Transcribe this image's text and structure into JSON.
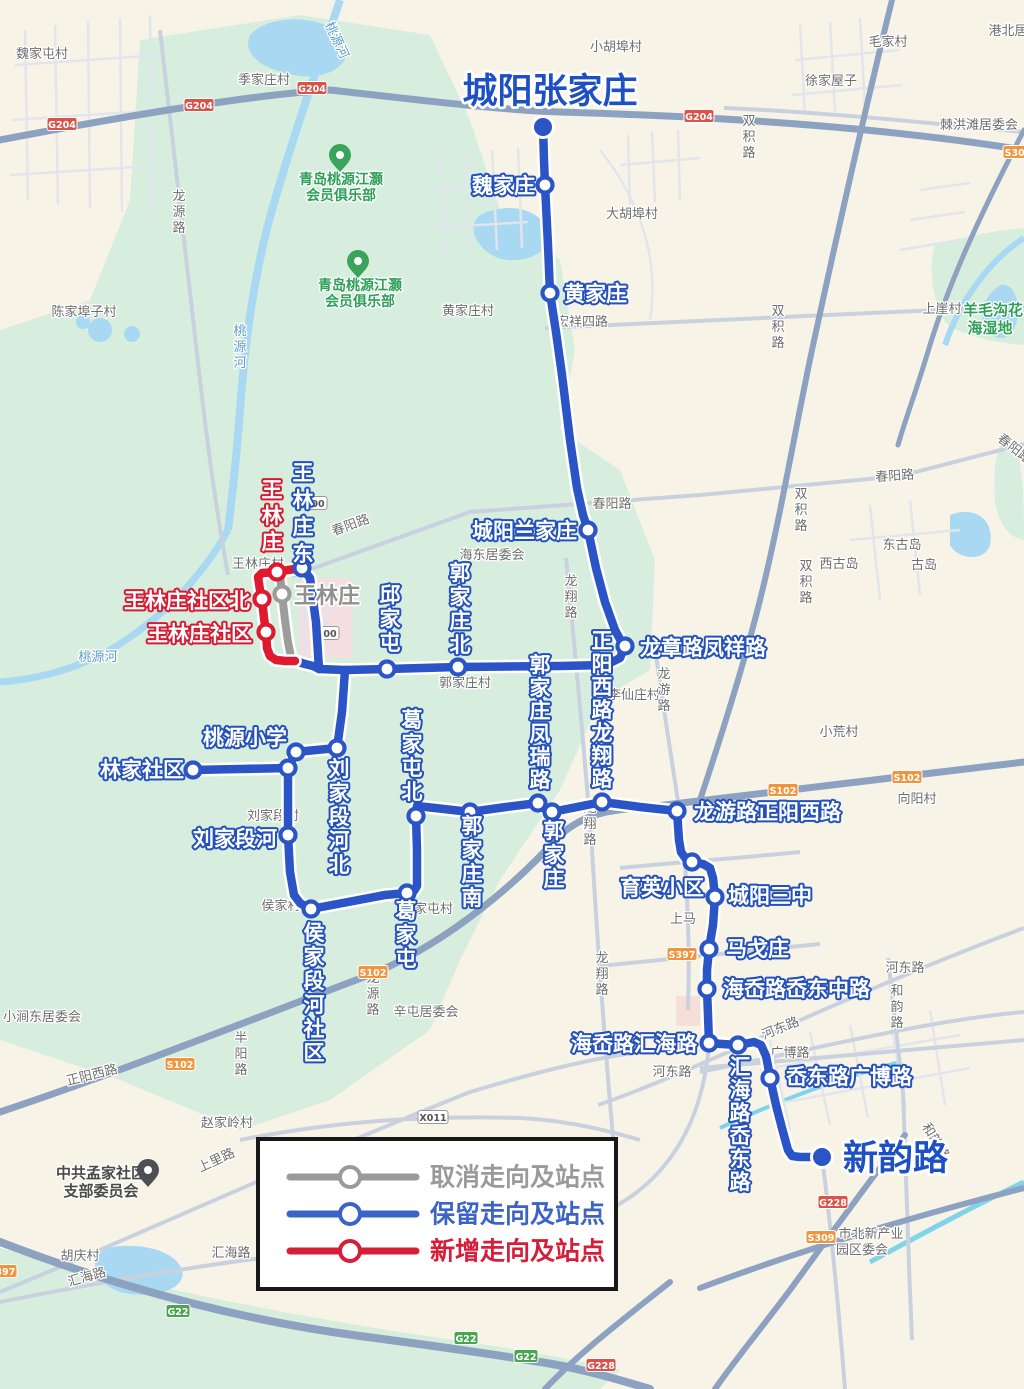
{
  "title": "城阳张家庄",
  "terminal_end": "新韵路",
  "legend": {
    "items": [
      {
        "label": "取消走向及站点",
        "color": "#9a9a9a"
      },
      {
        "label": "保留走向及站点",
        "color": "#3c63c6"
      },
      {
        "label": "新增走向及站点",
        "color": "#d61e39"
      }
    ]
  },
  "map": {
    "colors": {
      "blue": "#2b55c6",
      "red": "#de1a31",
      "gray": "#9c9c9c",
      "label_blue_outline": "#2350bb",
      "label_red_outline": "#d61a31",
      "title_blue": "#1d50c4",
      "bg_beige": "#f8f3e7",
      "bg_green": "#d7eede",
      "water": "#a9d9f2"
    },
    "route": {
      "blue": [
        "543,127 544,160 545,185 548,245 550,293 556,332 562,375 570,440 577,488 583,515 588,530 596,568 605,602 615,630 622,643 625,646",
        "625,646 620,658 606,665 560,666 458,667 387,669 345,670 319,669",
        "319,669 316,622 310,578 302,568",
        "295,661 305,664 313,666 319,669",
        "345,670 342,712 337,748",
        "337,748 316,750 296,752 288,768",
        "288,768 240,769 193,770",
        "288,768 288,820 288,835 290,872 294,895 300,903 308,908 311,909",
        "311,909 348,902 385,895 407,893 414,891 417,886 417,850 416,816 417,806",
        "417,806 444,809 470,812 506,807 538,803 546,810 552,812 577,807 602,802 640,807 677,811",
        "677,811 679,840 681,852 686,859 692,862 703,864 710,868 713,878 715,897 713,925 709,949 707,970 707,989 708,1015 709,1043",
        "709,1043 722,1044 738,1045 754,1042 761,1045 766,1056 768,1066 770,1078 776,1105 783,1132 788,1150 792,1156 800,1157 822,1157"
      ],
      "red": [
        "302,568 288,570 277,572 262,573 258,577 260,590 262,599 264,618 266,632 267,648 270,656 276,660 286,661 295,661"
      ],
      "gray": [
        "280,573 281,585 282,594 285,620 288,642 291,657"
      ]
    },
    "stops": [
      {
        "x": 543,
        "y": 127,
        "t": "T"
      },
      {
        "x": 822,
        "y": 1157,
        "t": "T"
      },
      {
        "x": 545,
        "y": 185,
        "t": "b"
      },
      {
        "x": 550,
        "y": 293,
        "t": "b"
      },
      {
        "x": 588,
        "y": 530,
        "t": "b"
      },
      {
        "x": 625,
        "y": 646,
        "t": "b"
      },
      {
        "x": 302,
        "y": 568,
        "t": "b"
      },
      {
        "x": 387,
        "y": 669,
        "t": "b"
      },
      {
        "x": 458,
        "y": 667,
        "t": "b"
      },
      {
        "x": 337,
        "y": 748,
        "t": "b"
      },
      {
        "x": 296,
        "y": 752,
        "t": "b"
      },
      {
        "x": 288,
        "y": 768,
        "t": "b"
      },
      {
        "x": 193,
        "y": 770,
        "t": "b"
      },
      {
        "x": 288,
        "y": 835,
        "t": "b"
      },
      {
        "x": 311,
        "y": 909,
        "t": "b"
      },
      {
        "x": 407,
        "y": 893,
        "t": "b"
      },
      {
        "x": 416,
        "y": 816,
        "t": "b"
      },
      {
        "x": 470,
        "y": 812,
        "t": "b"
      },
      {
        "x": 538,
        "y": 803,
        "t": "b"
      },
      {
        "x": 552,
        "y": 812,
        "t": "b"
      },
      {
        "x": 602,
        "y": 802,
        "t": "b"
      },
      {
        "x": 677,
        "y": 811,
        "t": "b"
      },
      {
        "x": 692,
        "y": 862,
        "t": "b"
      },
      {
        "x": 715,
        "y": 897,
        "t": "b"
      },
      {
        "x": 709,
        "y": 949,
        "t": "b"
      },
      {
        "x": 707,
        "y": 989,
        "t": "b"
      },
      {
        "x": 709,
        "y": 1043,
        "t": "b"
      },
      {
        "x": 738,
        "y": 1045,
        "t": "b"
      },
      {
        "x": 770,
        "y": 1078,
        "t": "b"
      },
      {
        "x": 277,
        "y": 572,
        "t": "r"
      },
      {
        "x": 262,
        "y": 599,
        "t": "r"
      },
      {
        "x": 266,
        "y": 632,
        "t": "r"
      },
      {
        "x": 282,
        "y": 594,
        "t": "g"
      }
    ],
    "stop_labels": [
      {
        "t": "城阳张家庄",
        "x": 550,
        "y": 103,
        "s": "T",
        "a": "middle"
      },
      {
        "t": "新韵路",
        "x": 843,
        "y": 1170,
        "s": "T"
      },
      {
        "t": "魏家庄",
        "x": 535,
        "y": 193,
        "a": "end"
      },
      {
        "t": "黄家庄",
        "x": 564,
        "y": 301
      },
      {
        "t": "城阳兰家庄",
        "x": 577,
        "y": 538,
        "a": "end"
      },
      {
        "t": "龙章路凤祥路",
        "x": 640,
        "y": 655
      },
      {
        "t": "王林庄东",
        "x": 303,
        "y": 480,
        "v": 1,
        "step": 27
      },
      {
        "t": "王林庄",
        "x": 272,
        "y": 497,
        "v": 1,
        "s": "R",
        "step": 26
      },
      {
        "t": "王林庄",
        "x": 294,
        "y": 603,
        "s": "G",
        "size": 22
      },
      {
        "t": "王林庄社区北",
        "x": 250,
        "y": 608,
        "s": "R",
        "a": "end"
      },
      {
        "t": "王林庄社区",
        "x": 252,
        "y": 641,
        "s": "R",
        "a": "end"
      },
      {
        "t": "邱家屯",
        "x": 390,
        "y": 602,
        "v": 1
      },
      {
        "t": "郭家庄北",
        "x": 460,
        "y": 580,
        "v": 1
      },
      {
        "t": "郭家庄凤瑞路",
        "x": 540,
        "y": 672,
        "v": 1,
        "size": 21,
        "step": 23
      },
      {
        "t": "正阳西路龙翔路",
        "x": 602,
        "y": 648,
        "v": 1,
        "size": 21,
        "step": 23
      },
      {
        "t": "桃源小学",
        "x": 287,
        "y": 745,
        "a": "end"
      },
      {
        "t": "林家社区",
        "x": 184,
        "y": 777,
        "a": "end"
      },
      {
        "t": "刘家段河北",
        "x": 339,
        "y": 776,
        "v": 1,
        "step": 24
      },
      {
        "t": "刘家段河",
        "x": 277,
        "y": 846,
        "a": "end"
      },
      {
        "t": "侯家段河社区",
        "x": 314,
        "y": 940,
        "v": 1,
        "step": 24
      },
      {
        "t": "葛家屯北",
        "x": 412,
        "y": 727,
        "v": 1,
        "step": 24
      },
      {
        "t": "葛家屯",
        "x": 406,
        "y": 918,
        "v": 1,
        "step": 24
      },
      {
        "t": "郭家庄南",
        "x": 472,
        "y": 833,
        "v": 1,
        "step": 24
      },
      {
        "t": "郭家庄",
        "x": 554,
        "y": 838,
        "v": 1,
        "step": 24
      },
      {
        "t": "龙游路正阳西路",
        "x": 694,
        "y": 819
      },
      {
        "t": "育英小区",
        "x": 704,
        "y": 895,
        "a": "end"
      },
      {
        "t": "城阳三中",
        "x": 728,
        "y": 903
      },
      {
        "t": "马戈庄",
        "x": 726,
        "y": 956
      },
      {
        "t": "海岙路岙东中路",
        "x": 723,
        "y": 996
      },
      {
        "t": "海岙路汇海路",
        "x": 697,
        "y": 1051,
        "a": "end"
      },
      {
        "t": "汇海路岙东路",
        "x": 740,
        "y": 1074,
        "v": 1,
        "size": 21,
        "step": 23
      },
      {
        "t": "岙东路广博路",
        "x": 786,
        "y": 1084
      }
    ],
    "bg_labels": [
      {
        "t": "魏家屯村",
        "x": 42,
        "y": 58
      },
      {
        "t": "季家庄村",
        "x": 264,
        "y": 84
      },
      {
        "t": "小胡埠村",
        "x": 616,
        "y": 51
      },
      {
        "t": "毛家村",
        "x": 888,
        "y": 46
      },
      {
        "t": "徐家屋子",
        "x": 831,
        "y": 85
      },
      {
        "t": "港北居",
        "x": 1008,
        "y": 35
      },
      {
        "t": "棘洪滩居委会",
        "x": 979,
        "y": 129
      },
      {
        "t": "羊毛沟花",
        "x": 993,
        "y": 315,
        "c": "n",
        "b": 1,
        "size": 15
      },
      {
        "t": "海湿地",
        "x": 990,
        "y": 333,
        "c": "n",
        "b": 1,
        "size": 15
      },
      {
        "t": "青岛桃源江灏",
        "x": 341,
        "y": 184,
        "c": "n",
        "b": 1,
        "size": 14
      },
      {
        "t": "会员俱乐部",
        "x": 341,
        "y": 200,
        "c": "n",
        "b": 1,
        "size": 14
      },
      {
        "t": "青岛桃源江灏",
        "x": 360,
        "y": 290,
        "c": "n",
        "b": 1,
        "size": 14
      },
      {
        "t": "会员俱乐部",
        "x": 360,
        "y": 306,
        "c": "n",
        "b": 1,
        "size": 14
      },
      {
        "t": "大胡埠村",
        "x": 632,
        "y": 218
      },
      {
        "t": "陈家埠子村",
        "x": 84,
        "y": 316
      },
      {
        "t": "黄家庄村",
        "x": 468,
        "y": 315
      },
      {
        "t": "宏祥四路",
        "x": 582,
        "y": 326
      },
      {
        "t": "上崖村",
        "x": 942,
        "y": 313
      },
      {
        "t": "东古岛",
        "x": 902,
        "y": 549
      },
      {
        "t": "西古岛",
        "x": 839,
        "y": 568
      },
      {
        "t": "古岛",
        "x": 924,
        "y": 569
      },
      {
        "t": "春阳路",
        "x": 352,
        "y": 529,
        "rot": -20
      },
      {
        "t": "春阳路",
        "x": 612,
        "y": 508
      },
      {
        "t": "春阳路",
        "x": 895,
        "y": 480,
        "rot": -4
      },
      {
        "t": "春阳路",
        "x": 1012,
        "y": 452,
        "rot": 38
      },
      {
        "t": "海东居委会",
        "x": 492,
        "y": 559
      },
      {
        "t": "王林庄村",
        "x": 258,
        "y": 568
      },
      {
        "t": "郭家庄村",
        "x": 465,
        "y": 687
      },
      {
        "t": "李仙庄村",
        "x": 634,
        "y": 699
      },
      {
        "t": "龙翔路",
        "x": 571,
        "y": 585,
        "v": 1
      },
      {
        "t": "龙翔路",
        "x": 590,
        "y": 812,
        "v": 1
      },
      {
        "t": "龙翔路",
        "x": 602,
        "y": 962,
        "v": 1
      },
      {
        "t": "龙游路",
        "x": 664,
        "y": 678,
        "v": 1
      },
      {
        "t": "龙源路",
        "x": 179,
        "y": 200,
        "v": 1
      },
      {
        "t": "龙源路",
        "x": 373,
        "y": 982,
        "v": 1
      },
      {
        "t": "桃源河",
        "x": 333,
        "y": 42,
        "c": "b",
        "rot": 65
      },
      {
        "t": "桃源河",
        "x": 240,
        "y": 335,
        "c": "b",
        "v": 1
      },
      {
        "t": "桃源河",
        "x": 98,
        "y": 661,
        "c": "b"
      },
      {
        "t": "小荒村",
        "x": 839,
        "y": 736
      },
      {
        "t": "向阳村",
        "x": 917,
        "y": 803
      },
      {
        "t": "双积路",
        "x": 749,
        "y": 125,
        "v": 1
      },
      {
        "t": "双积路",
        "x": 778,
        "y": 315,
        "v": 1
      },
      {
        "t": "双积路",
        "x": 801,
        "y": 498,
        "v": 1
      },
      {
        "t": "双积路",
        "x": 806,
        "y": 570,
        "v": 1
      },
      {
        "t": "刘家段村",
        "x": 273,
        "y": 820
      },
      {
        "t": "侯家村",
        "x": 281,
        "y": 910
      },
      {
        "t": "葛家屯村",
        "x": 427,
        "y": 913
      },
      {
        "t": "上马",
        "x": 683,
        "y": 923
      },
      {
        "t": "辛屯居委会",
        "x": 426,
        "y": 1016
      },
      {
        "t": "小涧东居委会",
        "x": 42,
        "y": 1021
      },
      {
        "t": "正阳西路",
        "x": 93,
        "y": 1079,
        "rot": -14
      },
      {
        "t": "赵家岭村",
        "x": 227,
        "y": 1127
      },
      {
        "t": "上里路",
        "x": 218,
        "y": 1164,
        "rot": -25
      },
      {
        "t": "中共孟家社区",
        "x": 101,
        "y": 1178,
        "c": "d",
        "size": 15,
        "b": 1
      },
      {
        "t": "支部委员会",
        "x": 101,
        "y": 1196,
        "c": "d",
        "size": 15,
        "b": 1
      },
      {
        "t": "胡庆村",
        "x": 80,
        "y": 1260
      },
      {
        "t": "汇海路",
        "x": 88,
        "y": 1281,
        "rot": -16
      },
      {
        "t": "汇海路",
        "x": 231,
        "y": 1257
      },
      {
        "t": "河东路",
        "x": 905,
        "y": 972
      },
      {
        "t": "河东路",
        "x": 782,
        "y": 1032,
        "rot": -22
      },
      {
        "t": "河东路",
        "x": 672,
        "y": 1076
      },
      {
        "t": "和韵路",
        "x": 897,
        "y": 995,
        "v": 1
      },
      {
        "t": "和韵路",
        "x": 932,
        "y": 1143,
        "rot": 58
      },
      {
        "t": "广博路",
        "x": 790,
        "y": 1057
      },
      {
        "t": "半阳路",
        "x": 241,
        "y": 1042,
        "v": 1
      },
      {
        "t": "市北新产业",
        "x": 871,
        "y": 1238
      },
      {
        "t": "园区委会",
        "x": 862,
        "y": 1254
      }
    ],
    "shields": [
      {
        "t": "G204",
        "x": 62,
        "y": 124,
        "k": "r"
      },
      {
        "t": "G204",
        "x": 199,
        "y": 105,
        "k": "r"
      },
      {
        "t": "G204",
        "x": 312,
        "y": 88,
        "k": "r"
      },
      {
        "t": "G204",
        "x": 699,
        "y": 116,
        "k": "r"
      },
      {
        "t": "G228",
        "x": 601,
        "y": 1365,
        "k": "r"
      },
      {
        "t": "G228",
        "x": 833,
        "y": 1202,
        "k": "r"
      },
      {
        "t": "S102",
        "x": 180,
        "y": 1064,
        "k": "o"
      },
      {
        "t": "S102",
        "x": 373,
        "y": 972,
        "k": "o"
      },
      {
        "t": "S102",
        "x": 907,
        "y": 777,
        "k": "o"
      },
      {
        "t": "S102",
        "x": 783,
        "y": 790,
        "k": "o"
      },
      {
        "t": "S397",
        "x": 682,
        "y": 954,
        "k": "o"
      },
      {
        "t": "S397",
        "x": 2,
        "y": 1271,
        "k": "o"
      },
      {
        "t": "S309",
        "x": 821,
        "y": 1237,
        "k": "o"
      },
      {
        "t": "S309",
        "x": 1018,
        "y": 152,
        "k": "o"
      },
      {
        "t": "G22",
        "x": 178,
        "y": 1311,
        "k": "g"
      },
      {
        "t": "G22",
        "x": 466,
        "y": 1338,
        "k": "g"
      },
      {
        "t": "G22",
        "x": 526,
        "y": 1356,
        "k": "g"
      },
      {
        "t": "X011",
        "x": 433,
        "y": 1117,
        "k": "w"
      },
      {
        "t": "00",
        "x": 318,
        "y": 503,
        "k": "w"
      },
      {
        "t": "00",
        "x": 330,
        "y": 633,
        "k": "w"
      }
    ]
  }
}
